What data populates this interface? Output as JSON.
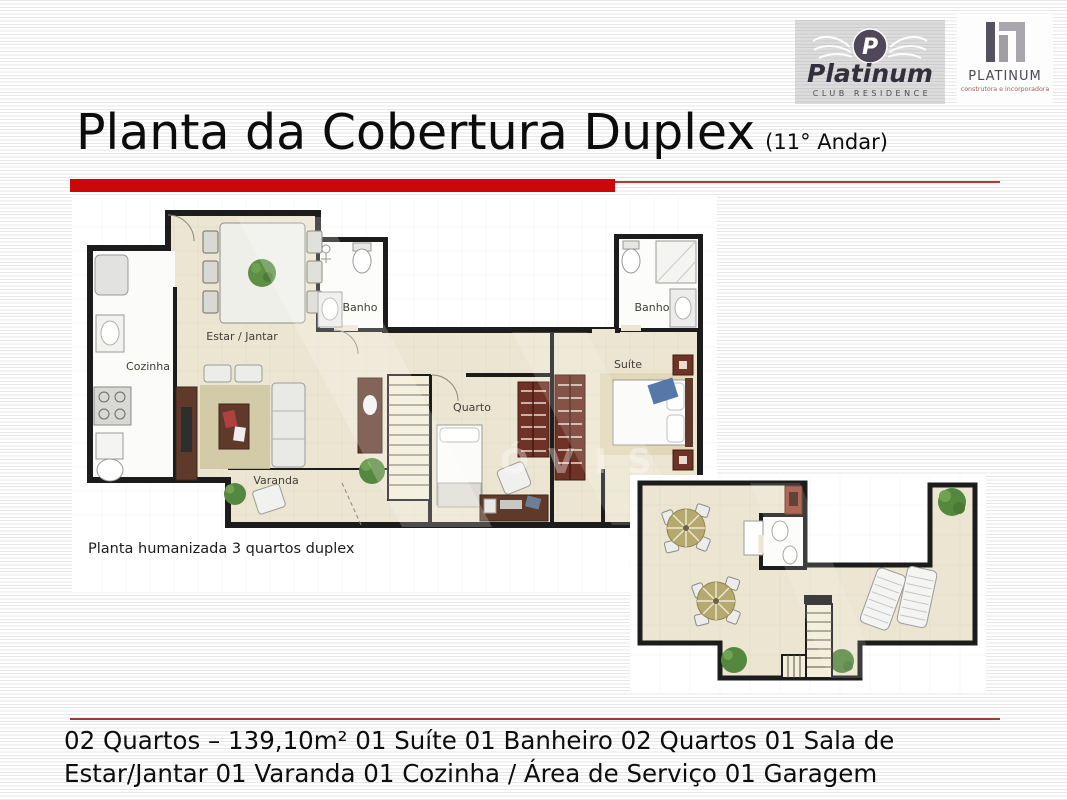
{
  "header": {
    "logo_club": {
      "monogram": "P",
      "brand": "Platinum",
      "tagline": "CLUB RESIDENCE"
    },
    "logo_builder": {
      "brand": "PLATINUM",
      "tagline": "construtora e incorporadora"
    },
    "title": "Planta da Cobertura Duplex",
    "title_suffix": "(11° Andar)"
  },
  "main_plan": {
    "caption": "Planta humanizada 3 quartos duplex",
    "watermark": "ÓVIS",
    "labels": {
      "cozinha": "Cozinha",
      "estar_jantar": "Estar / Jantar",
      "banho_social": "Banho",
      "banho_suite": "Banho",
      "quarto": "Quarto",
      "suite": "Suíte",
      "varanda": "Varanda"
    }
  },
  "footer": {
    "line1": "02 Quartos – 139,10m² 01 Suíte 01 Banheiro 02 Quartos 01 Sala de",
    "line2": "Estar/Jantar 01 Varanda 01 Cozinha / Área de Serviço 01 Garagem"
  },
  "colors": {
    "accent_red": "#cc0707",
    "footer_rule": "#a03a3a",
    "floor_beige": "#ece5d1",
    "wall_black": "#1c1c1c",
    "wood_brown": "#5f3a2a",
    "wardrobe_red_brown": "#6e3226",
    "plant_green": "#55883f",
    "parasol_olive": "#b5a96e",
    "logo_slate": "#4e4859"
  }
}
